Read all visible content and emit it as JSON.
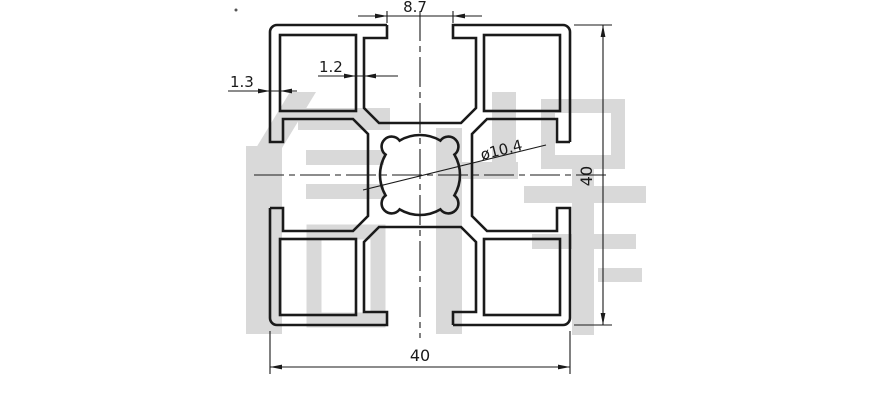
{
  "drawing": {
    "watermark": {
      "text": "信牌"
    },
    "colors": {
      "line": "#1a1a1a",
      "thin_line": "#1a1a1a",
      "watermark": "#d9d9d9",
      "background": "#ffffff"
    },
    "dimensions": {
      "slot_opening": "8.7",
      "inner_wall_thickness": "1.2",
      "outer_wall_thickness": "1.3",
      "center_bore_diameter": "ø10.4",
      "overall_height": "40",
      "overall_width": "40"
    }
  }
}
